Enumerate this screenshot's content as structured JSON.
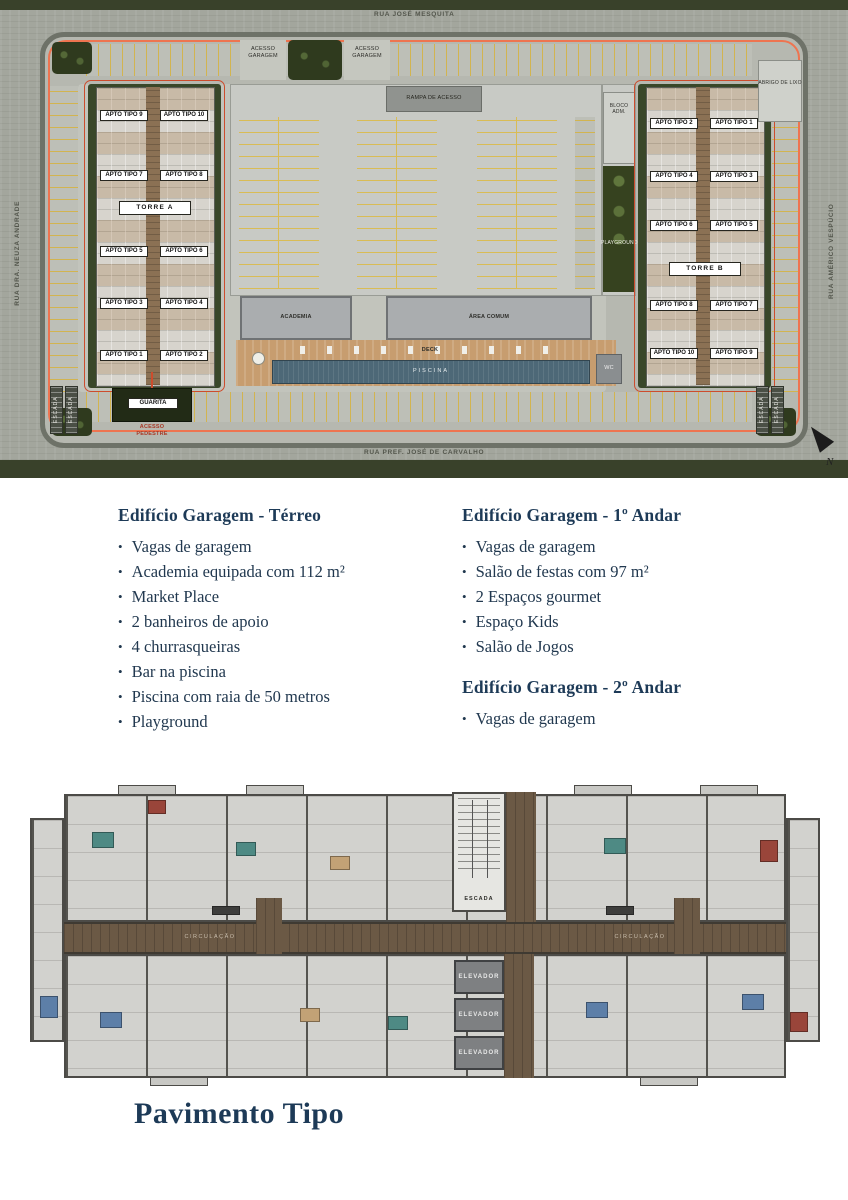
{
  "site_plan": {
    "streets": {
      "top": "RUA JOSÉ MESQUITA",
      "left": "RUA DRA. NEUZA ANDRADE",
      "right": "RUA AMÉRICO VESPÚCIO",
      "bottom": "RUA PREF. JOSÉ DE CARVALHO"
    },
    "access": {
      "garage": "ACESSO GARAGEM",
      "pedestrian": "ACESSO PEDESTRE"
    },
    "areas": {
      "ramp": "RAMPA DE ACESSO",
      "admin_block": "BLOCO ADM.",
      "trash_shelter": "ABRIGO DE LIXO",
      "playground": "PLAYGROUND",
      "gym": "ACADEMIA",
      "common_area": "ÁREA COMUM",
      "deck": "DECK",
      "pool": "PISCINA",
      "wc": "WC",
      "guardhouse": "GUARITA",
      "corner_stairs": "ESCADA"
    },
    "north_indicator": "N",
    "torre_a": {
      "name": "TORRE A",
      "units": [
        "APTO TIPO 9",
        "APTO TIPO 10",
        "APTO TIPO 7",
        "APTO TIPO 8",
        "APTO TIPO 5",
        "APTO TIPO 6",
        "APTO TIPO 3",
        "APTO TIPO 4",
        "APTO TIPO 1",
        "APTO TIPO 2"
      ]
    },
    "torre_b": {
      "name": "TORRE B",
      "units": [
        "APTO TIPO 2",
        "APTO TIPO 1",
        "APTO TIPO 4",
        "APTO TIPO 3",
        "APTO TIPO 6",
        "APTO TIPO 5",
        "APTO TIPO 8",
        "APTO TIPO 7",
        "APTO TIPO 10",
        "APTO TIPO 9"
      ]
    }
  },
  "amenities": {
    "ground_floor": {
      "title": "Edifício Garagem - Térreo",
      "items": [
        "Vagas de garagem",
        "Academia equipada com 112 m²",
        "Market Place",
        "2 banheiros de apoio",
        "4 churrasqueiras",
        "Bar na piscina",
        "Piscina com raia de 50 metros",
        "Playground"
      ]
    },
    "first_floor": {
      "title": "Edifício Garagem - 1º Andar",
      "items": [
        "Vagas de garagem",
        "Salão de festas com 97 m²",
        "2 Espaços gourmet",
        "Espaço Kids",
        "Salão de Jogos"
      ]
    },
    "second_floor": {
      "title": "Edifício Garagem - 2º Andar",
      "items": [
        "Vagas de garagem"
      ]
    }
  },
  "typical_floor": {
    "title": "Pavimento Tipo",
    "stairs": "ESCADA",
    "corridor": "CIRCULAÇÃO",
    "elevator": "ELEVADOR"
  }
}
